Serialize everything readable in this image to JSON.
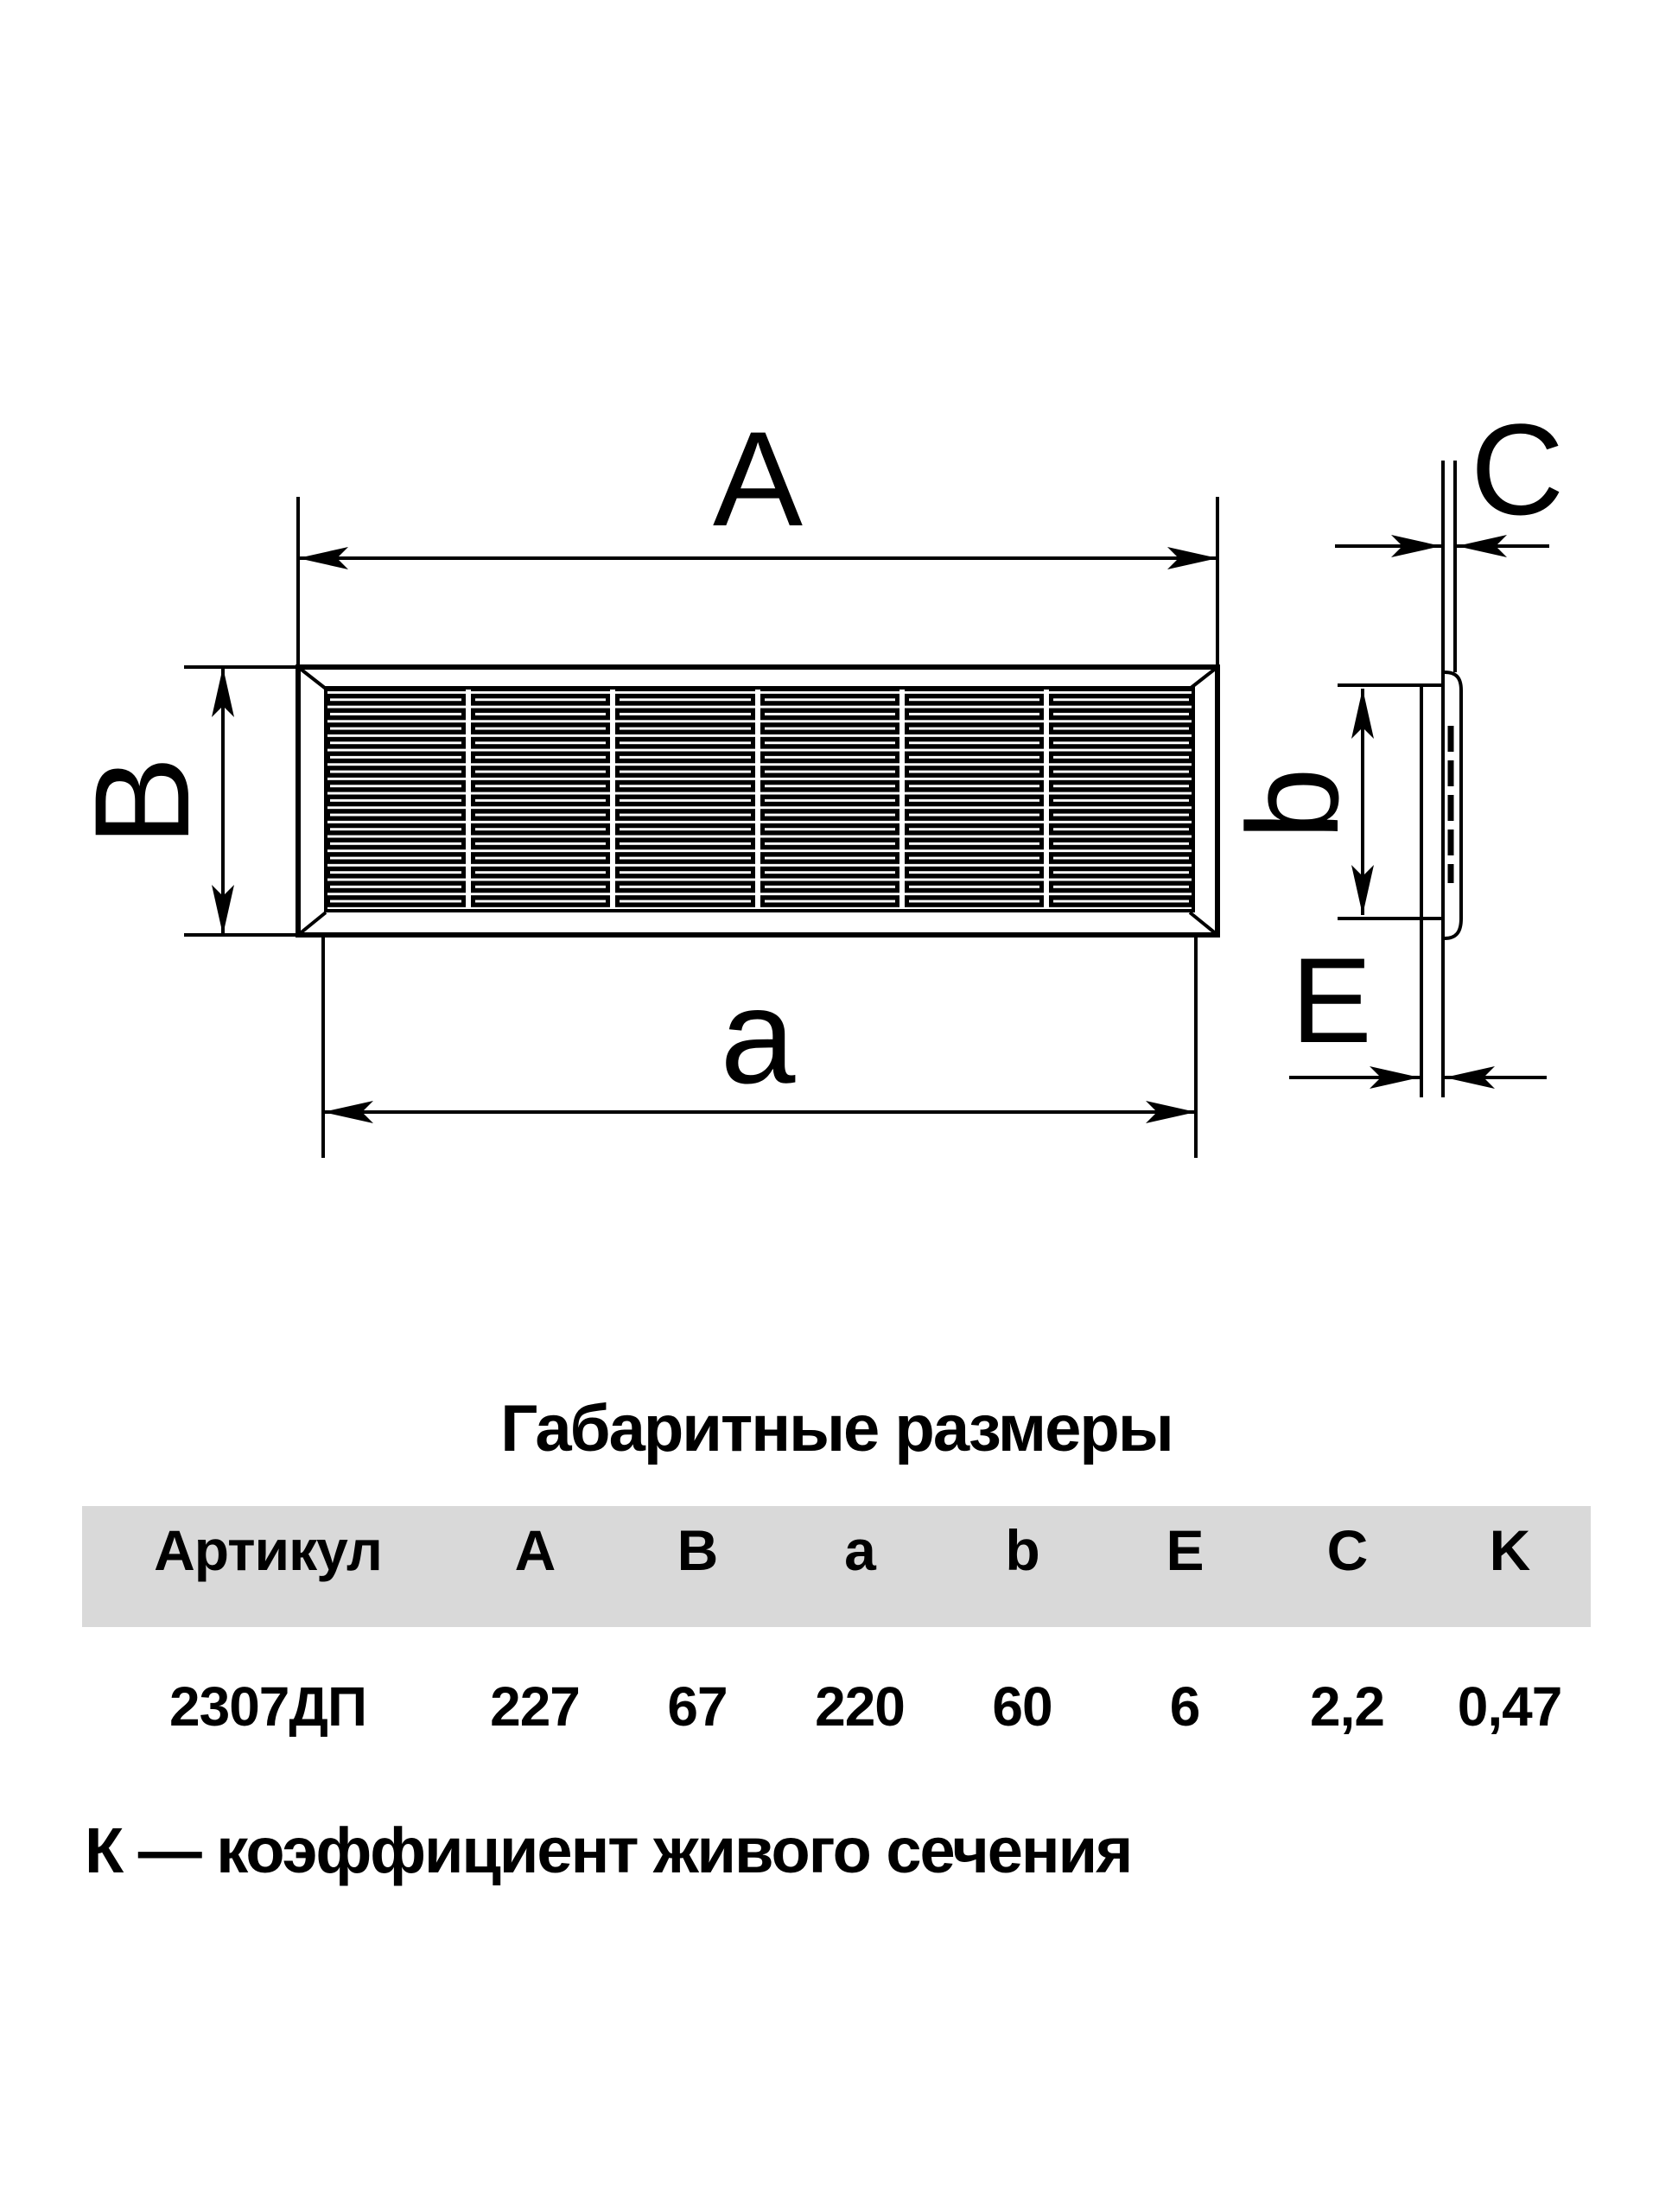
{
  "drawing": {
    "front_view": {
      "label_width_outer": "A",
      "label_height_outer": "B",
      "label_width_inner": "a"
    },
    "side_view": {
      "label_thickness": "C",
      "label_height_inner": "b",
      "label_depth": "E"
    }
  },
  "dimensions_table": {
    "title": "Габаритные размеры",
    "columns": [
      "Артикул",
      "A",
      "B",
      "a",
      "b",
      "E",
      "C",
      "K"
    ],
    "rows": [
      [
        "2307ДП",
        "227",
        "67",
        "220",
        "60",
        "6",
        "2,2",
        "0,47"
      ]
    ]
  },
  "footnote": {
    "text": "К — коэффициент живого сечения"
  },
  "colors": {
    "line": "#000000",
    "text": "#000000",
    "table_header_bg": "#d9d9d9",
    "background": "#ffffff"
  }
}
